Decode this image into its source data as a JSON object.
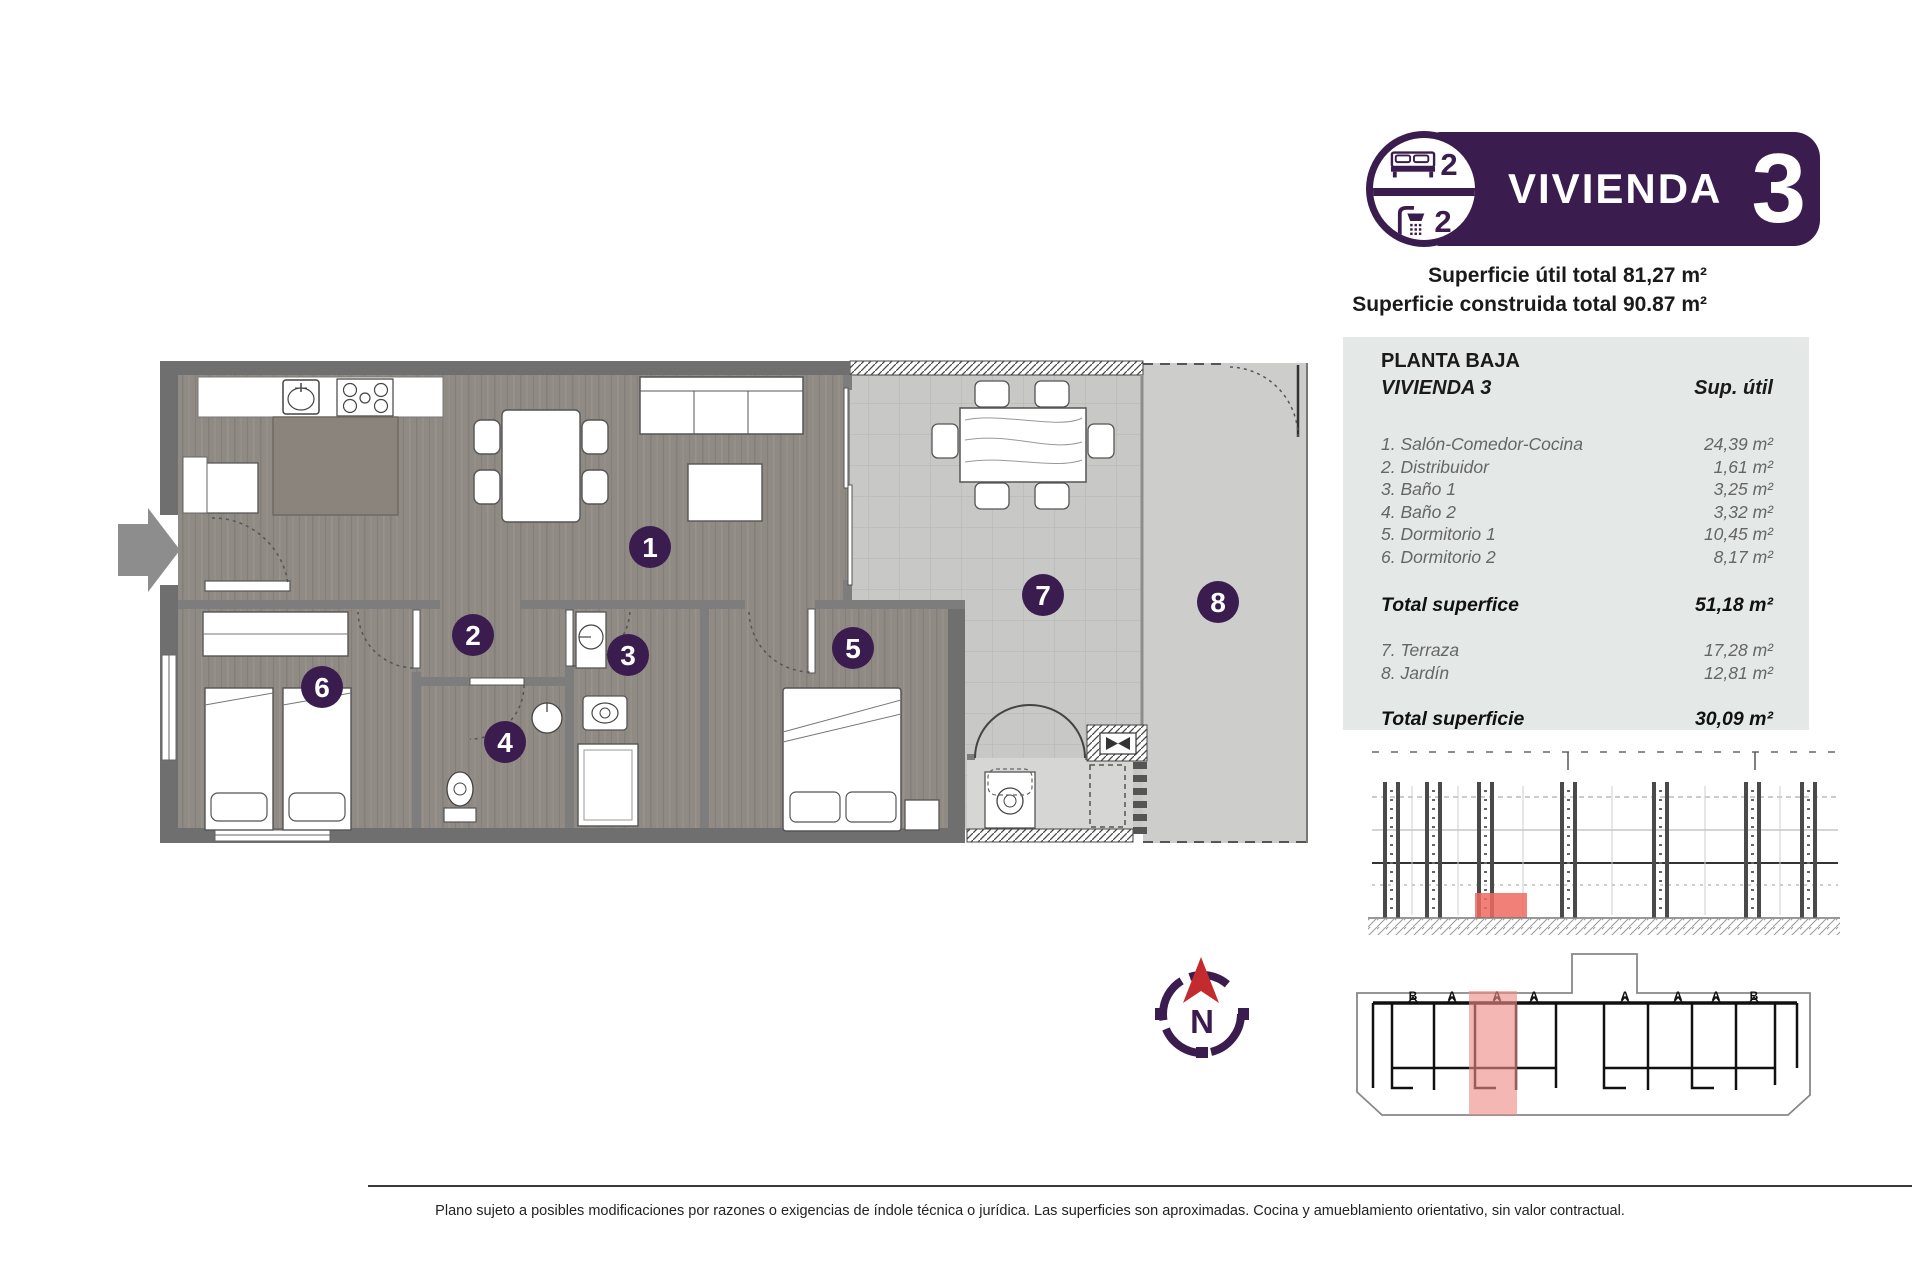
{
  "accent_colors": {
    "purple": "#3b1c4e",
    "compass_red": "#c32b2f",
    "unit_highlight_red": "#ee6a61",
    "unit_highlight_pink": "#ee8b85",
    "table_background": "#e4e8e7"
  },
  "badge": {
    "title": "VIVIENDA",
    "number": "3",
    "bedrooms": "2",
    "bathrooms": "2"
  },
  "areas": {
    "util": {
      "label": "Superficie útil total",
      "value": "81,27 m²"
    },
    "construida": {
      "label": "Superficie construida total",
      "value": "90.87 m²"
    }
  },
  "table": {
    "title": "PLANTA BAJA",
    "subtitle": "VIVIENDA 3",
    "col_header": "Sup. útil",
    "rows_interior": [
      {
        "label": "1. Salón-Comedor-Cocina",
        "value": "24,39 m²"
      },
      {
        "label": "2. Distribuidor",
        "value": "1,61 m²"
      },
      {
        "label": "3. Baño 1",
        "value": "3,25 m²"
      },
      {
        "label": "4. Baño 2",
        "value": "3,32 m²"
      },
      {
        "label": "5. Dormitorio 1",
        "value": "10,45 m²"
      },
      {
        "label": "6. Dormitorio 2",
        "value": "8,17 m²"
      }
    ],
    "total_interior": {
      "label": "Total superfice",
      "value": "51,18 m²"
    },
    "rows_exterior": [
      {
        "label": "7. Terraza",
        "value": "17,28 m²"
      },
      {
        "label": "8. Jardín",
        "value": "12,81 m²"
      }
    ],
    "total_exterior": {
      "label": "Total superficie",
      "value": "30,09 m²"
    }
  },
  "plan": {
    "room_numbers": [
      "1",
      "2",
      "3",
      "4",
      "5",
      "6",
      "7",
      "8"
    ]
  },
  "siteplan": {
    "letters": [
      "B",
      "A",
      "A",
      "A",
      "A",
      "A",
      "A",
      "B"
    ]
  },
  "compass": {
    "north_label": "N"
  },
  "footer": {
    "disclaimer": "Plano sujeto a posibles modificaciones por razones o exigencias de índole técnica o jurídica. Las superficies son aproximadas. Cocina y amueblamiento orientativo, sin valor contractual."
  }
}
